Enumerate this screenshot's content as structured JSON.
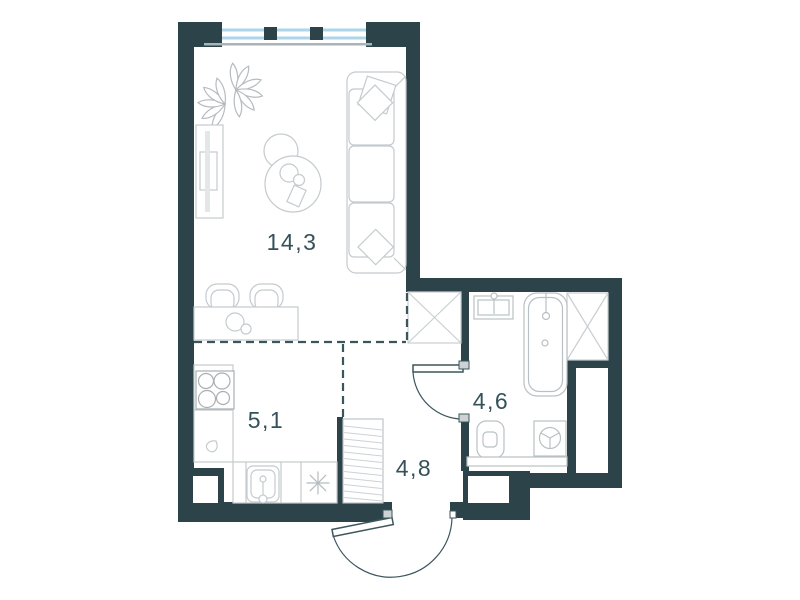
{
  "plan": {
    "title": "studio-apartment-floor-plan",
    "rooms": [
      {
        "name": "living-room",
        "label": "14,3"
      },
      {
        "name": "kitchen",
        "label": "5,1"
      },
      {
        "name": "bathroom",
        "label": "4,6"
      },
      {
        "name": "hallway",
        "label": "4,8"
      }
    ],
    "colors": {
      "wall": "#2c434a",
      "window_glass": "#aed6ea",
      "sill": "#aab3b6",
      "furniture_line": "#c4cacd",
      "appliance_line": "#a8afb2",
      "door_line": "#3c565c",
      "dashed_line": "#3a555b",
      "label_text": "#35525a",
      "screen_fill": "#e4e7e8",
      "hinge_fill": "#cdd3d5"
    },
    "icons": [
      "window-icon",
      "plant-icon",
      "tv-stand-icon",
      "coffee-table-icon",
      "sofa-icon",
      "pillow-icon",
      "dining-table-icon",
      "chair-icon",
      "stove-icon",
      "kitchen-sink-icon",
      "hob-icon",
      "kettle-icon",
      "wardrobe-icon",
      "entrance-door-icon",
      "bathroom-door-icon",
      "washbasin-icon",
      "bathtub-icon",
      "toilet-icon",
      "washing-machine-icon",
      "shelf-icon",
      "vent-shaft-icon"
    ]
  }
}
